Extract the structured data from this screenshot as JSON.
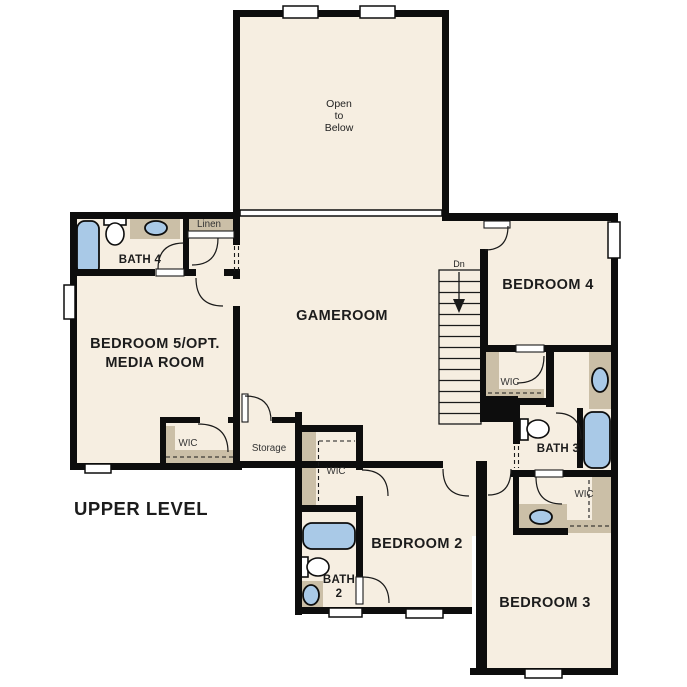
{
  "plan_label": "UPPER LEVEL",
  "colors": {
    "wall": "#0d0d0d",
    "line": "#1a1a1a",
    "room_fill": "#f6eee1",
    "closet_fill": "#cbbfa7",
    "fixture_blue": "#a9c9e7",
    "background": "#ffffff"
  },
  "rooms": {
    "open_to_below": {
      "lines": [
        "Open",
        "to",
        "Below"
      ]
    },
    "gameroom": {
      "label": "GAMEROOM"
    },
    "bedroom4": {
      "label": "BEDROOM 4"
    },
    "bedroom5": {
      "lines": [
        "BEDROOM 5/OPT.",
        "MEDIA ROOM"
      ]
    },
    "bedroom2": {
      "label": "BEDROOM 2"
    },
    "bedroom3": {
      "label": "BEDROOM 3"
    },
    "bath4": {
      "label": "BATH 4"
    },
    "bath3": {
      "label": "BATH 3"
    },
    "bath2": {
      "lines": [
        "BATH",
        "2"
      ]
    },
    "linen": {
      "label": "Linen"
    },
    "storage": {
      "label": "Storage"
    },
    "wic_bedroom5": {
      "label": "WIC"
    },
    "wic_bedroom2": {
      "label": "WIC"
    },
    "wic_bedroom4": {
      "label": "WIC"
    },
    "wic_bedroom3": {
      "label": "WIC"
    }
  },
  "stairs": {
    "direction_label": "Dn"
  },
  "fixture_symbols": [
    "bathtub",
    "toilet",
    "sink-vanity",
    "window",
    "door-swing",
    "stairs"
  ]
}
